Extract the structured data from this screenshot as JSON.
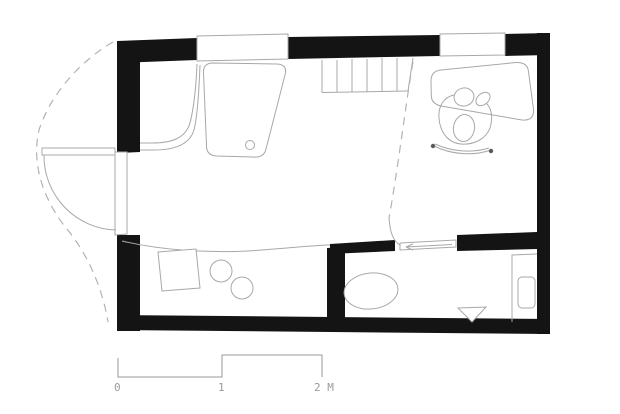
{
  "drawing": {
    "type": "architectural-floor-plan",
    "background_color": "#ffffff",
    "wall_color": "#141414",
    "furniture_line_color": "#a8a8a8",
    "scale_bar": {
      "labels": {
        "zero": "0",
        "one": "1",
        "two": "2 M"
      },
      "color": "#9a9a9a"
    },
    "fixtures": [
      "entry-door",
      "door-swing",
      "roof-overhang-outline",
      "bench",
      "bed-unit",
      "window",
      "stairs",
      "headroom-line",
      "desk",
      "person-on-chair",
      "loft-edge",
      "kitchen-table",
      "stool",
      "stool",
      "sliding-door",
      "toilet",
      "floor-drain",
      "washbasin"
    ]
  }
}
